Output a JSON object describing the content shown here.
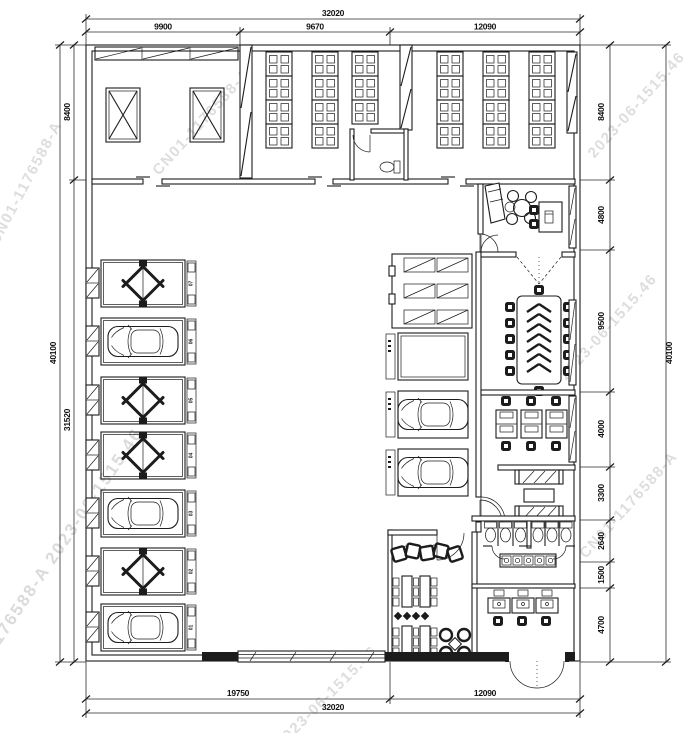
{
  "watermark": {
    "part1": "CN01-1176588-A",
    "part2": "2023-06-1515.46",
    "full": "CN01-1176588-A 2023-06-1515.46"
  },
  "dimensions": {
    "top": {
      "total": "32020",
      "segments": [
        "9900",
        "9670",
        "12090"
      ]
    },
    "bottom": {
      "total": "32020",
      "segments": [
        "19750",
        "12090"
      ]
    },
    "left": {
      "outer": "40100",
      "inner": [
        "8400",
        "31520"
      ]
    },
    "right": {
      "outer": "40100",
      "inner": [
        "8400",
        "4800",
        "9500",
        "4000",
        "3300",
        "2640",
        "1500",
        "4700"
      ]
    }
  },
  "bays": {
    "labels": [
      "07",
      "06",
      "05",
      "04",
      "03",
      "02",
      "01"
    ]
  }
}
